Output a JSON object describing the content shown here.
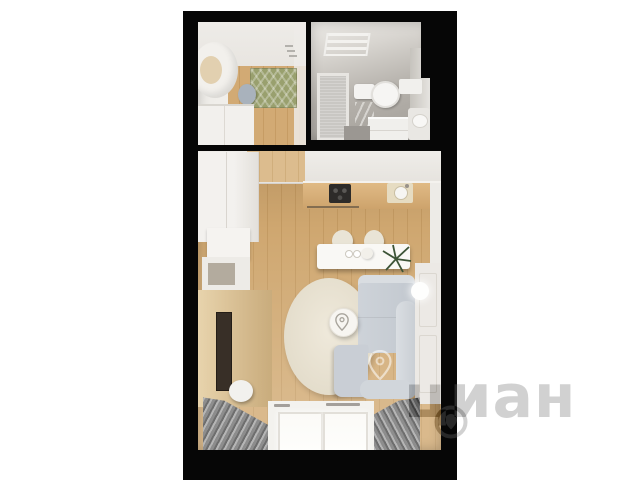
{
  "image": {
    "type": "3d-floorplan-render",
    "background": "#ffffff",
    "matte_color": "#060606"
  },
  "watermark": {
    "text": "циан",
    "logo": "pin-in-circle",
    "color": "#2e2e2e"
  },
  "rooms": {
    "hallway": {
      "name": "hallway",
      "features": [
        "open door",
        "green chevron doormat",
        "wood floor",
        "white wardrobe",
        "stool",
        "wall hooks"
      ]
    },
    "bathroom": {
      "name": "bathroom",
      "features": [
        "towel radiator",
        "frosted glass door",
        "toilet",
        "ladder towel rail",
        "vanity cabinet",
        "washbasin",
        "gray tile walls"
      ]
    },
    "living_room": {
      "name": "studio living room",
      "features": [
        "kitchen counter",
        "cooktop",
        "kitchen sink",
        "dining table",
        "two chairs",
        "plant",
        "round rug",
        "coffee table",
        "corner sofa",
        "wall tv",
        "pouf",
        "window",
        "curtains",
        "wall lamp",
        "closet",
        "shelving unit"
      ]
    }
  },
  "palette": {
    "wood_floor": "#cda36e",
    "wall_white": "#efede9",
    "bathroom_tile": "#b5b1ab",
    "sofa": "#ccd1d7",
    "rug": "#e8e1d0",
    "doormat": "#99a06e",
    "curtains": "#8d8d8d",
    "tv": "#382f27",
    "counter": "#d6ae77",
    "cooktop": "#2d2b29",
    "plant": "#3c5336"
  }
}
